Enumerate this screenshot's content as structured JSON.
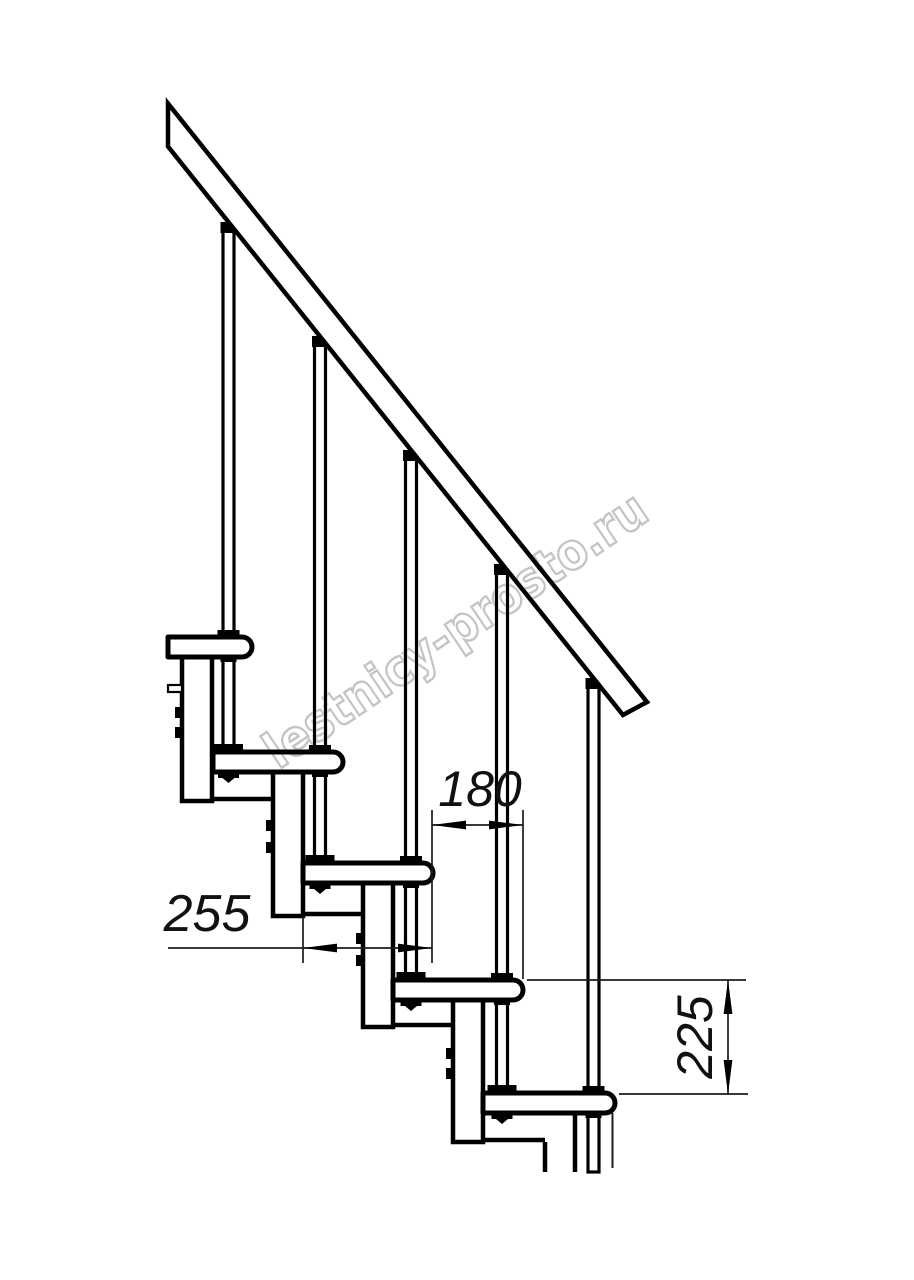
{
  "drawing": {
    "background": "#ffffff",
    "line_color": "#000000",
    "dimension_line_color": "#1c1c1c",
    "watermark": {
      "text": "lestnicy-prosto.ru",
      "color": "#c4c4c4"
    },
    "dimensions": {
      "step_run": {
        "value": "180"
      },
      "tread_depth": {
        "value": "255"
      },
      "riser_height": {
        "value": "225"
      }
    }
  }
}
